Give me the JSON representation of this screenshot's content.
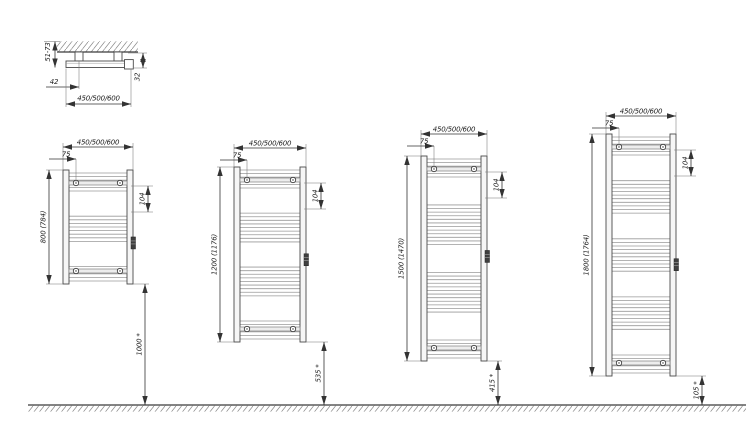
{
  "drawing_type": "towel-radiator-installation-dimensions",
  "top_view": {
    "wall_clearance": "51-73",
    "bracket_offset": "42",
    "depth": "32",
    "width": "450/500/600"
  },
  "radiators": [
    {
      "width": "450/500/600",
      "bracket_inset": "75",
      "connection_spacing": "104",
      "height": "800 (784)",
      "floor_distance": "1000 *"
    },
    {
      "width": "450/500/600",
      "bracket_inset": "75",
      "connection_spacing": "104",
      "height": "1200 (1176)",
      "floor_distance": "535 *"
    },
    {
      "width": "450/500/600",
      "bracket_inset": "75",
      "connection_spacing": "104",
      "height": "1500 (1470)",
      "floor_distance": "415 *"
    },
    {
      "width": "450/500/600",
      "bracket_inset": "75",
      "connection_spacing": "104",
      "height": "1800 (1764)",
      "floor_distance": "105 *"
    }
  ]
}
